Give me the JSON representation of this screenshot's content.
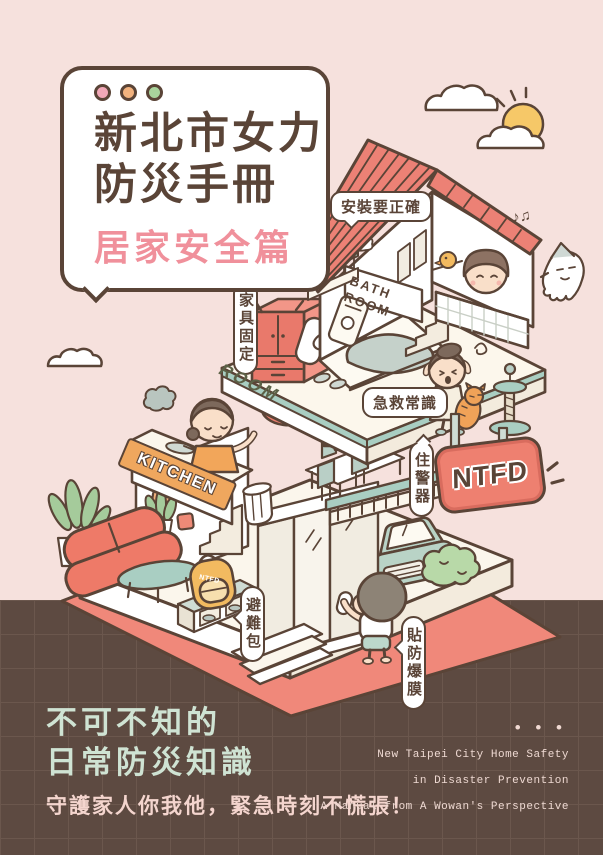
{
  "colors": {
    "background": "#f6e1dd",
    "footer_bg": "#5d4a41",
    "outline_brown": "#5a4437",
    "roof_red": "#ec8175",
    "ground_salmon": "#f0887a",
    "teal": "#a9cec2",
    "kitchen_orange": "#efa75e",
    "sign_red": "#ee8070",
    "title_pink": "#f0909b",
    "mint_text": "#cfe3d3",
    "pink_text": "#f4d5ce"
  },
  "title_card": {
    "dot_styles": [
      "background:#f2a8b8",
      "background:#f2b27e",
      "background:#a9d49c"
    ],
    "line1": "新北市女力",
    "line2": "防災手冊",
    "subtitle": "居家安全篇"
  },
  "house_labels": {
    "install": "安裝要正確",
    "bath_line1": "BATH",
    "bath_line2": "ROOM",
    "furniture": "家具固定",
    "room": "ROOM",
    "first_aid": "急救常識",
    "kitchen": "KITCHEN",
    "alarm": "住警器",
    "ntfd": "NTFD",
    "go_bag": "避難包",
    "backpack": "NTFD",
    "film": "貼防爆膜",
    "music_notes": "♪♫"
  },
  "footer": {
    "headline1": "不可不知的",
    "headline2": "日常防災知識",
    "tagline": "守護家人你我他，緊急時刻不慌張！",
    "dots": "• • •",
    "en1": "New Taipei City Home Safety",
    "en2": "in Disaster Prevention",
    "en3": "A Manual from A Wowan's Perspective"
  }
}
